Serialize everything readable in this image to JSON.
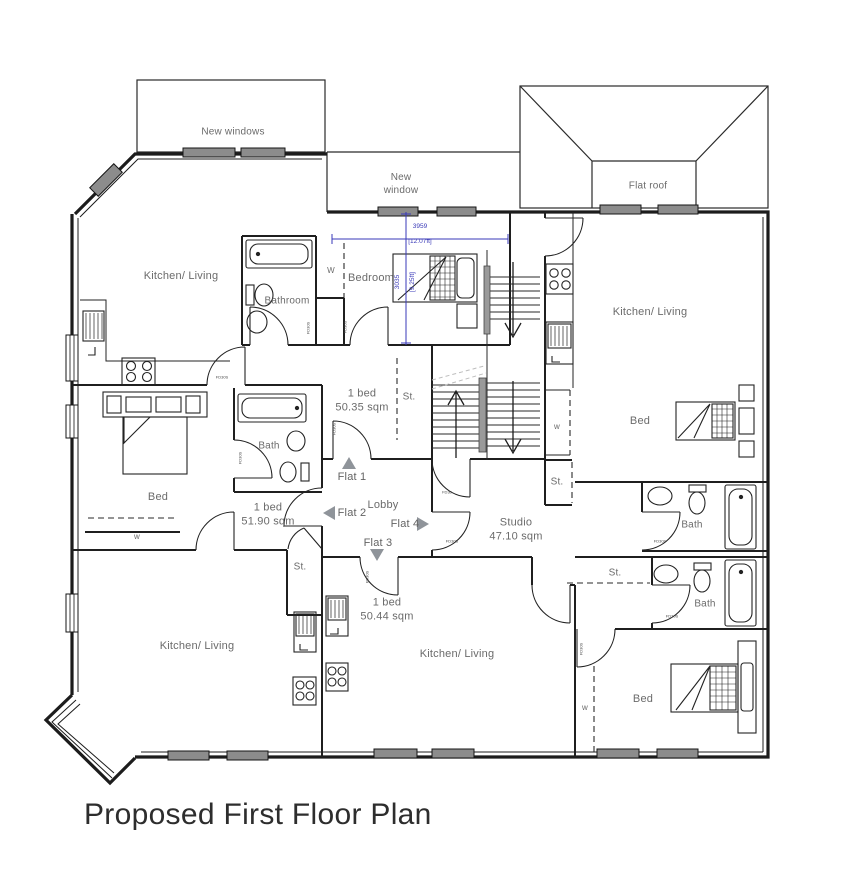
{
  "title": "Proposed First Floor Plan",
  "roof": {
    "new_windows": "New windows",
    "new_window": "New\nwindow",
    "flat_roof": "Flat roof"
  },
  "rooms": {
    "kitchen_living_top_left": "Kitchen/ Living",
    "bathroom_top_left": "Bathroom",
    "bedroom_top": "Bedroom",
    "kitchen_living_right": "Kitchen/ Living",
    "bed_right": "Bed",
    "bed_left": "Bed",
    "bath_left": "Bath",
    "lobby": "Lobby",
    "bath_right_upper": "Bath",
    "bath_right_lower": "Bath",
    "kitchen_living_bottom_left": "Kitchen/ Living",
    "kitchen_living_bottom_middle": "Kitchen/ Living",
    "bed_bottom_right": "Bed"
  },
  "storage": {
    "st_hall": "St.",
    "st_left": "St.",
    "st_mid": "St.",
    "st_bottom": "St."
  },
  "wardrobes": {
    "bedroom_top": "W",
    "right_flat": "w",
    "bed_left": "w",
    "bed_bottom_right": "w"
  },
  "flats": {
    "flat1": {
      "label": "Flat 1",
      "area": "1 bed\n50.35 sqm"
    },
    "flat2": {
      "label": "Flat 2",
      "area": "1 bed\n51.90 sqm"
    },
    "flat3": {
      "label": "Flat 3",
      "area": "1 bed\n50.44 sqm"
    },
    "flat4": {
      "label": "Flat 4",
      "area": "Studio\n47.10 sqm"
    }
  },
  "dimensions": {
    "width_mm": "3959",
    "width_ft": "[12.07ft]",
    "height_mm": "3035",
    "height_ft": "[9.25ft]",
    "color": "#3a3ab8"
  },
  "door_tags": {
    "fire_door": "FD30S",
    "fire_door_short": "FD30"
  }
}
